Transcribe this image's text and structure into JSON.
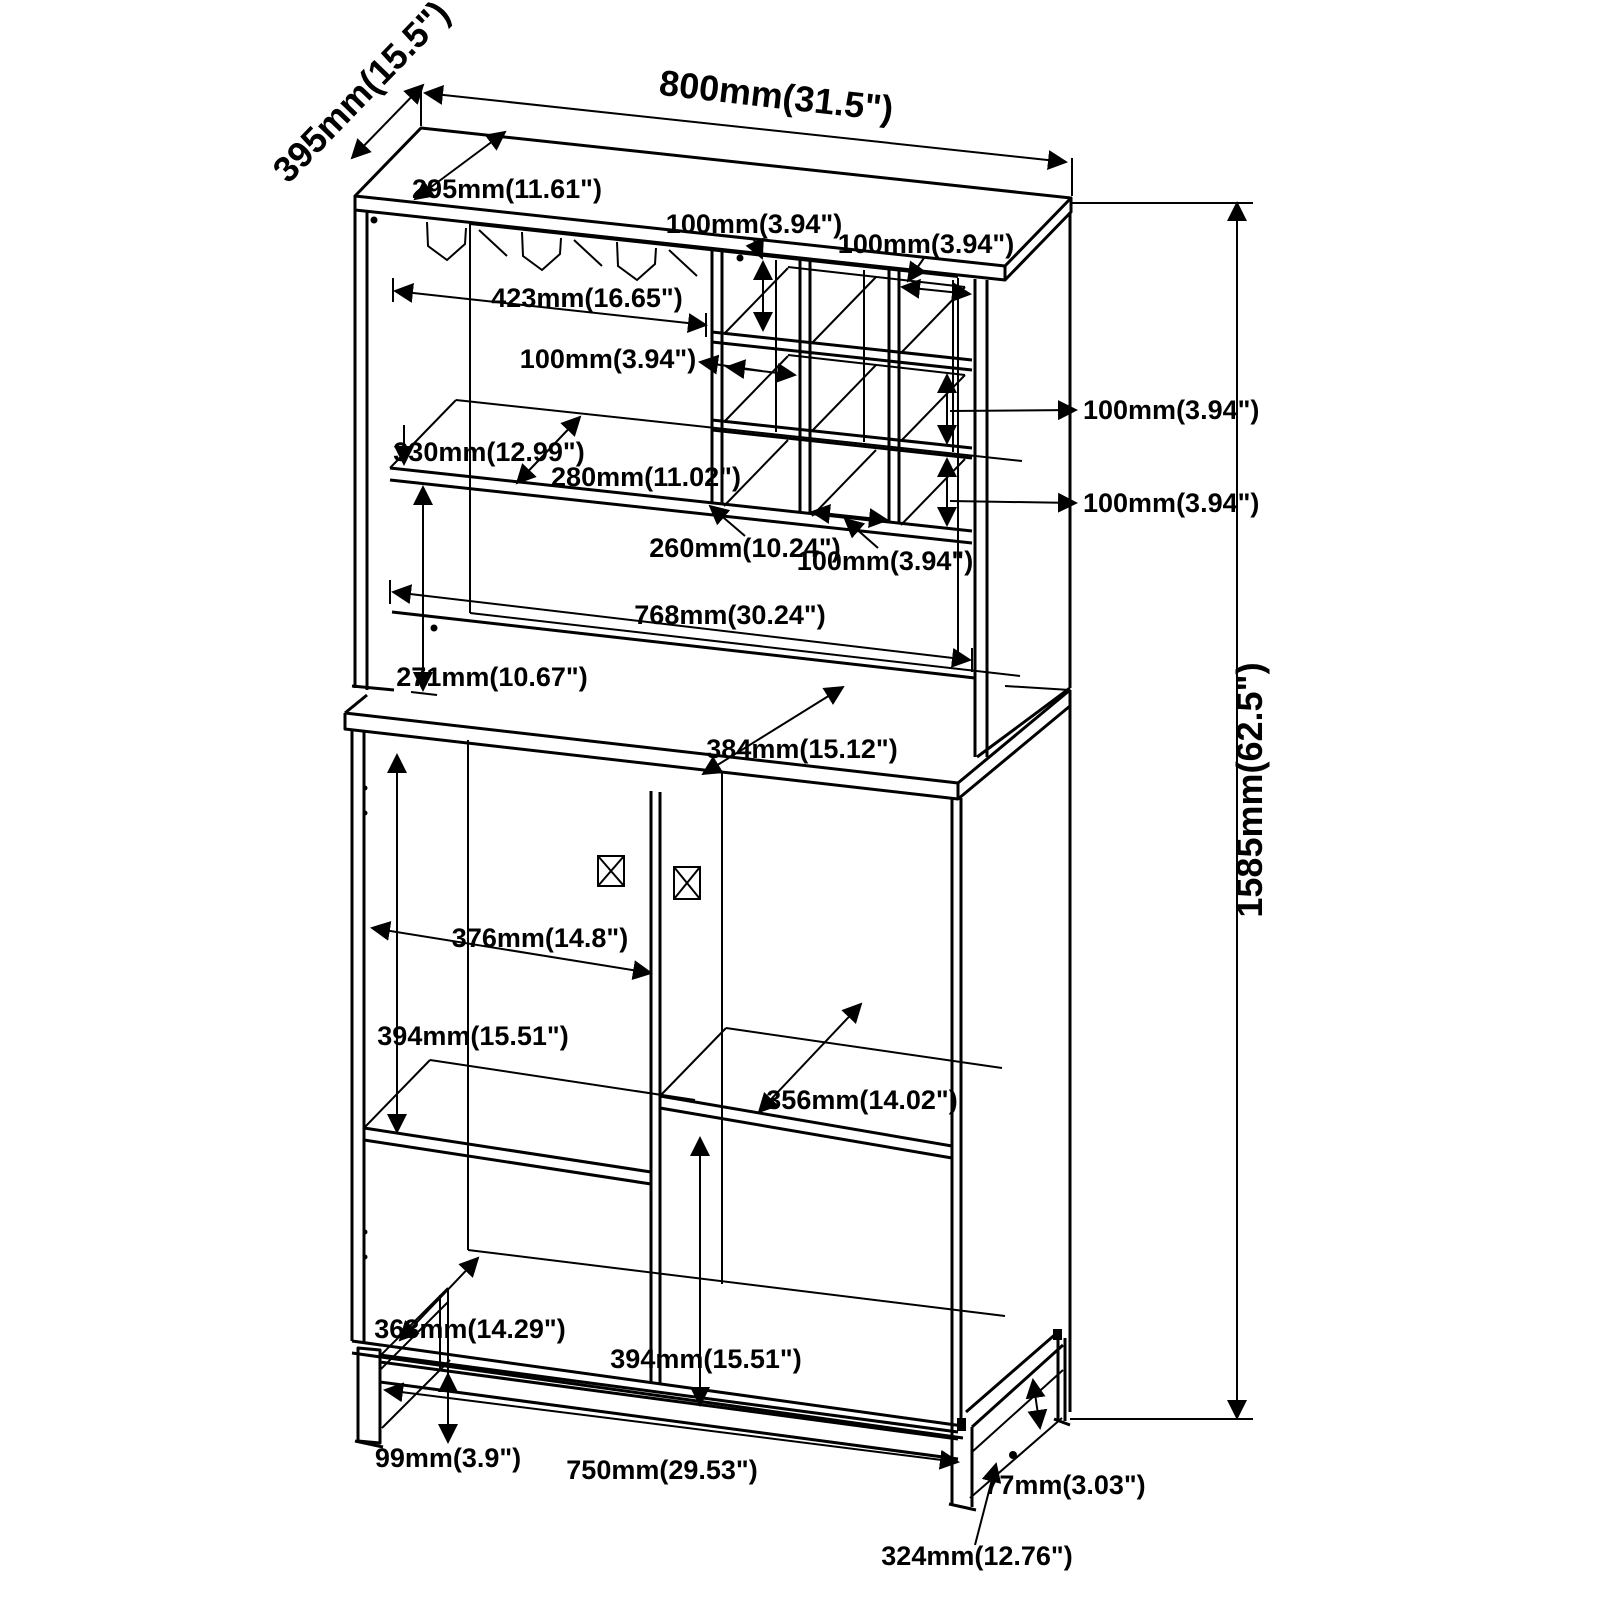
{
  "drawing": {
    "type": "furniture assembly dimension drawing",
    "subject": "bar cabinet with stemware rack, wine cubby grid and two-door lower cabinet on metal base",
    "background_color": "#ffffff",
    "line_color": "#000000",
    "overall": {
      "width": "800mm(31.5\")",
      "depth": "395mm(15.5\")",
      "height": "1585mm(62.5\")"
    },
    "labels": {
      "top_width": "800mm(31.5\")",
      "top_depth": "395mm(15.5\")",
      "top_inner_depth": "295mm(11.61\")",
      "rack_opening_width": "423mm(16.65\")",
      "cubby_row1_height": "100mm(3.94\")",
      "cubby_col_right_width": "100mm(3.94\")",
      "cubby_col_mid_width": "100mm(3.94\")",
      "shelf_clearance": "330mm(12.99\")",
      "shelf_depth": "280mm(11.02\")",
      "cubby_bottom_depth": "260mm(10.24\")",
      "cubby_bottom_width": "100mm(3.94\")",
      "cubby_row2_height": "100mm(3.94\")",
      "cubby_row3_height": "100mm(3.94\")",
      "hutch_opening_width": "768mm(30.24\")",
      "hutch_opening_height": "271mm(10.67\")",
      "counter_depth": "384mm(15.12\")",
      "door_opening_width": "376mm(14.8\")",
      "upper_compartment_height": "394mm(15.51\")",
      "right_shelf_depth": "356mm(14.02\")",
      "lower_compartment_depth": "363mm(14.29\")",
      "lower_compartment_height": "394mm(15.51\")",
      "base_height": "99mm(3.9\")",
      "base_width": "750mm(29.53\")",
      "base_rail_height": "77mm(3.03\")",
      "base_side_depth": "324mm(12.76\")",
      "overall_height": "1585mm(62.5\")"
    }
  }
}
